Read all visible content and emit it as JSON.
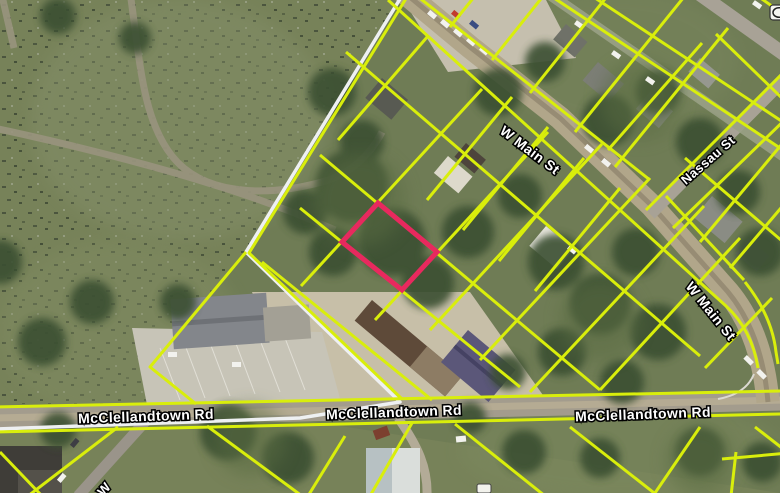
{
  "map": {
    "type": "parcel-gis-aerial-view",
    "street_labels": {
      "w_main_upper": "W Main St",
      "w_main_lower": "W Main St",
      "nassau": "Nassau St",
      "mcclellandtown_west": "McClellandtown Rd",
      "mcclellandtown_center": "McClellandtown Rd",
      "mcclellandtown_east": "McClellandtown Rd",
      "partial_west_street": "W"
    },
    "overlay_colors": {
      "parcel_line": "#d9ee0b",
      "selected_parcel_outline": "#e8295e",
      "municipal_boundary": "#eef0f2",
      "label_text": "#ffffff",
      "label_halo": "#000000"
    }
  }
}
